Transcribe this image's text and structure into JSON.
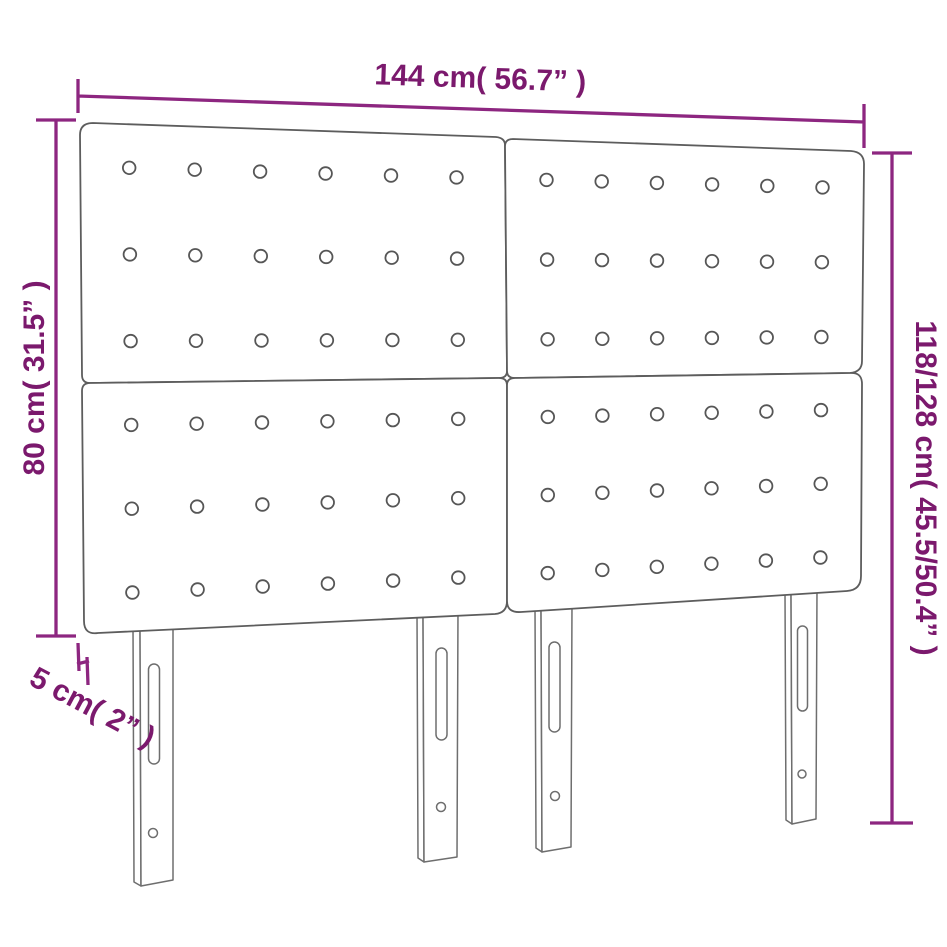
{
  "diagram": {
    "name": "headboard-dimension-diagram",
    "type": "product-dimension-drawing",
    "labels": {
      "width": "144 cm( 56.7” )",
      "panel_height": "80 cm( 31.5” )",
      "total_height": "118/128 cm( 45.5/50.4” )",
      "depth": "5 cm( 2” )"
    },
    "values": {
      "width_cm": 144,
      "width_in": 56.7,
      "panel_height_cm": 80,
      "panel_height_in": 31.5,
      "total_height_cm_min": 118,
      "total_height_cm_max": 128,
      "total_height_in_min": 45.5,
      "total_height_in_max": 50.4,
      "depth_cm": 5,
      "depth_in": 2
    },
    "structure": {
      "panels": 4,
      "legs": 4,
      "button_grid": {
        "rows": 3,
        "cols": 6
      }
    },
    "colors": {
      "dimension_line": "#8d2680",
      "dimension_text": "#7b196d",
      "outline": "#5d5d5d",
      "background": "#ffffff"
    }
  }
}
